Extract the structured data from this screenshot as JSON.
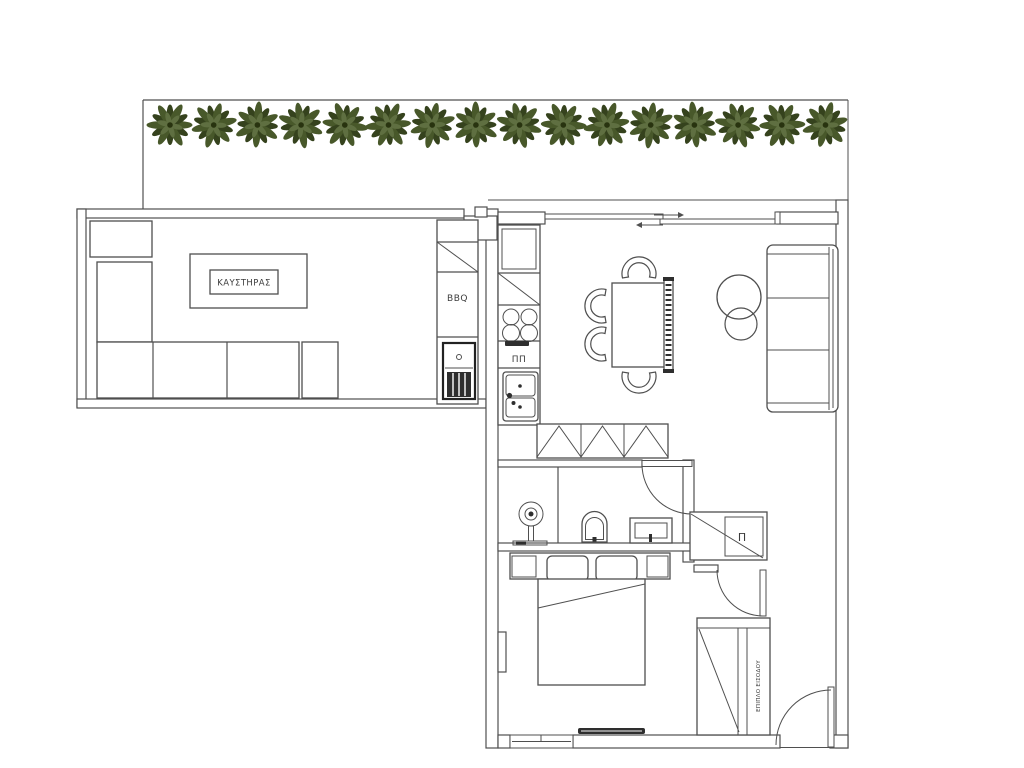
{
  "document": {
    "type": "apartment-floor-plan",
    "background": "#ffffff"
  },
  "colors": {
    "line": "#4f4f4f",
    "dark_fill": "#2e2e2e",
    "leaf_dark": "#35421d",
    "leaf_mid": "#48582a",
    "leaf_light": "#5f6f41",
    "leaf_core": "#28330f"
  },
  "labels": {
    "boiler": "ΚΑΥΣΤΗΡΑΣ",
    "bbq": "BBQ",
    "dishwasher": "ΠΠ",
    "washer": "Π",
    "entrance_furniture": "ΕΠΙΠΛΟ ΕΙΣΟΔΟΥ"
  },
  "plants": {
    "count": 16,
    "start_x": 170,
    "spacing": 43.7,
    "center_y": 125
  }
}
